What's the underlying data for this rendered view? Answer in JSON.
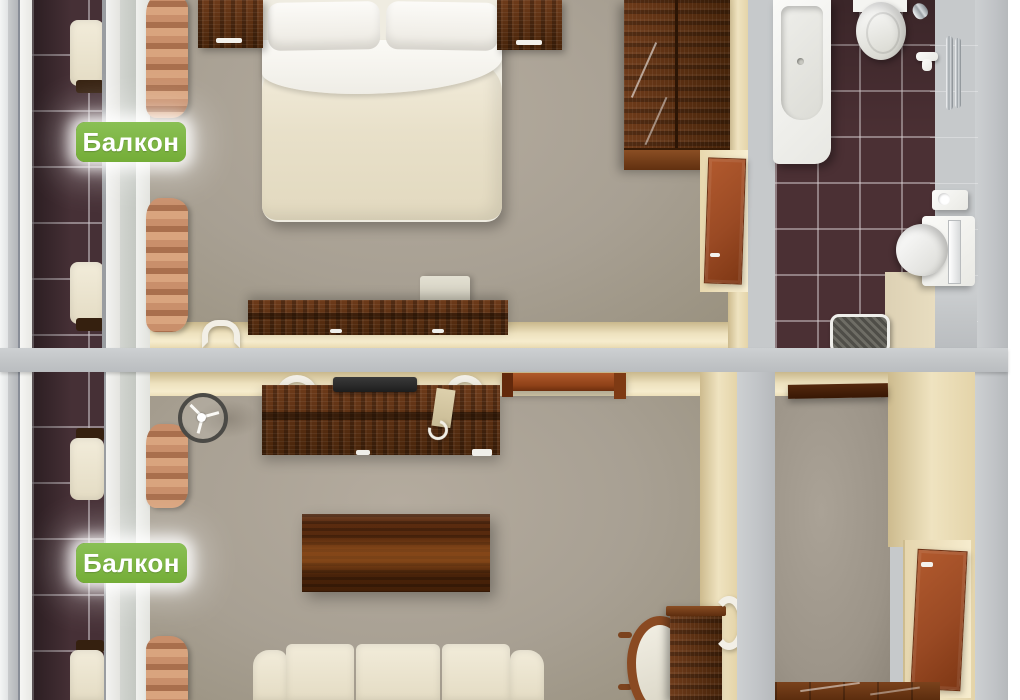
{
  "labels": {
    "balcony_top": "Балкон",
    "balcony_bottom": "Балкон"
  },
  "colors": {
    "badge_green": "#7cb440",
    "badge_text": "#ffffff",
    "wall_gray": "#c6c9cb",
    "wall_cream": "#efe3c0",
    "carpet_floor": "#a8a093",
    "dark_tile": "#4b3034",
    "beige_tile": "#ddd2b6",
    "dark_wood": "#5c2f13",
    "door_wood": "#9a4a24",
    "bedding_cream": "#e9e1cc",
    "curtain_salmon": "#c98f6b",
    "window_glass_blue": "#5d6dab"
  },
  "rooms": [
    {
      "name": "balcony-upper",
      "objects": [
        "tile-floor",
        "chair",
        "chair",
        "railing"
      ]
    },
    {
      "name": "bedroom",
      "objects": [
        "double-bed",
        "pillows",
        "nightstand-left",
        "nightstand-right",
        "wardrobe",
        "dresser-desk",
        "chair",
        "wall-sconce",
        "curtains",
        "door"
      ]
    },
    {
      "name": "bathroom",
      "objects": [
        "bathtub",
        "toilet",
        "sink",
        "mirror",
        "towel-rail",
        "toilet-paper-holder",
        "shelf",
        "waste-basket"
      ]
    },
    {
      "name": "balcony-lower",
      "objects": [
        "tile-floor",
        "chair",
        "chair",
        "railing"
      ]
    },
    {
      "name": "living-room",
      "objects": [
        "desk",
        "laptop",
        "desk-chair",
        "desk-chair",
        "wall-shelf",
        "coffee-table",
        "sofa",
        "side-chair",
        "cabinet",
        "fan",
        "wall-sconce",
        "curtains"
      ]
    },
    {
      "name": "hallway",
      "objects": [
        "wall-shelf",
        "entry-door",
        "wood-floor"
      ]
    }
  ]
}
